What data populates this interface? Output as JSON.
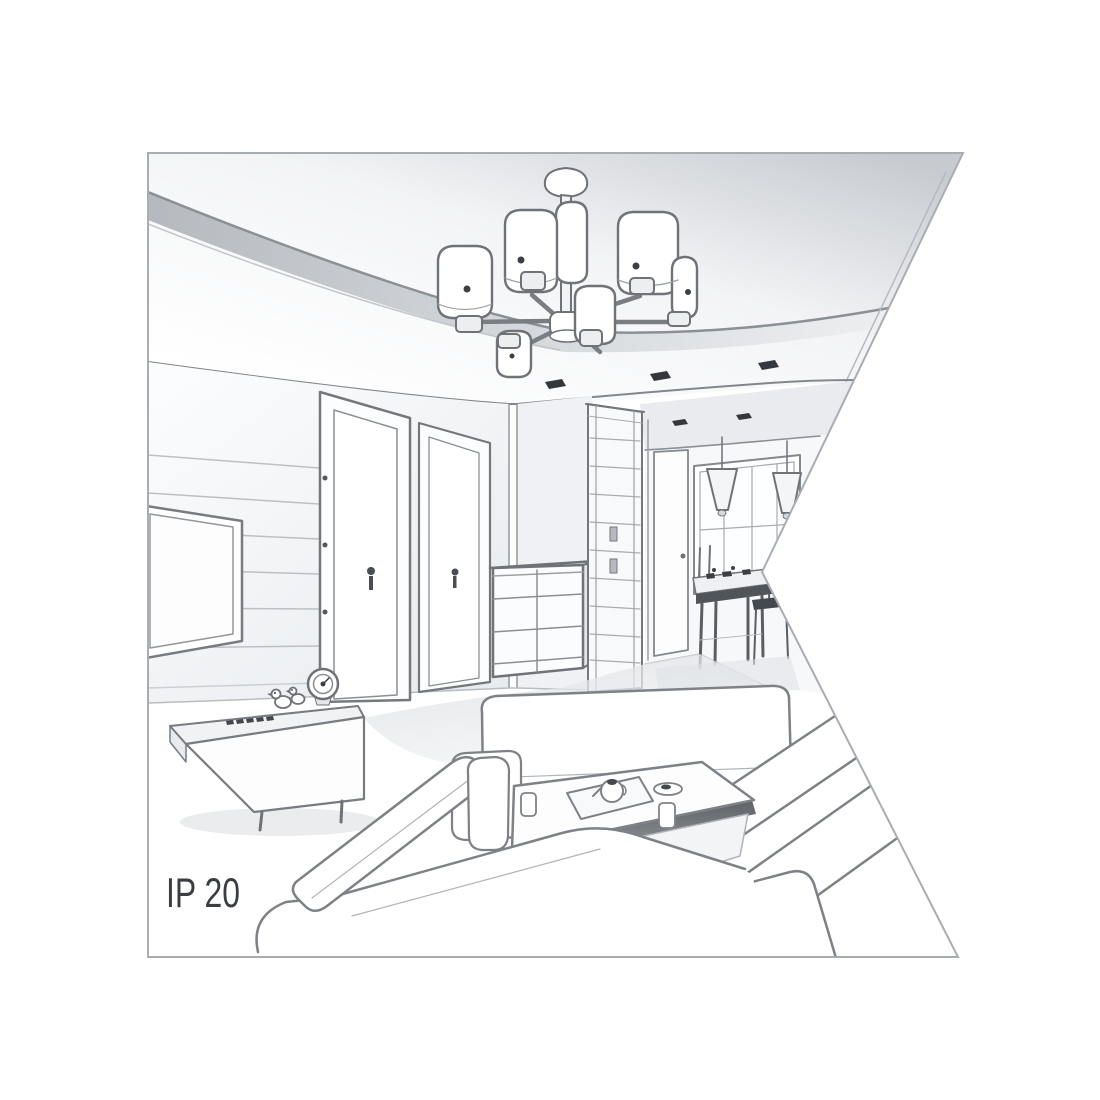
{
  "label": {
    "text": "IP 20"
  },
  "palette": {
    "background": "#ffffff",
    "line": "#74787d",
    "line_dark": "#4a4e52",
    "shade_light": "#eff1f4",
    "shade_mid": "#d7dade",
    "shade_dark": "#aeb3b8",
    "accent_dark": "#34383c",
    "label_text": "#3a3d41"
  },
  "scene": {
    "style": "grayscale 3D line-art interior rendering clipped by a triangular notch on the right",
    "room": "living room with hallway and dining nook",
    "objects": [
      "six-arm ceiling chandelier with cylindrical shades",
      "recessed ceiling spotlights",
      "wall-mounted TV panel",
      "two interior doors",
      "glass-front wardrobe",
      "chest of drawers",
      "hallway door",
      "window",
      "cone pendant lamps",
      "dining table with chairs",
      "media console",
      "table clock",
      "duck figurines",
      "corner sofa set",
      "coffee table with tea set"
    ]
  }
}
